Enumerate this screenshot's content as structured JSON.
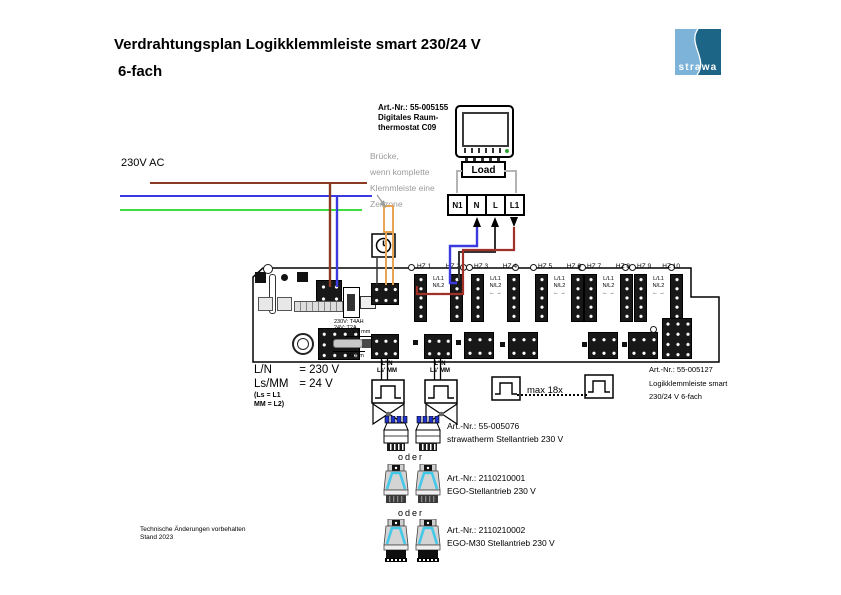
{
  "title": {
    "line1": "Verdrahtungsplan Logikklemmleiste smart 230/24 V",
    "line2": "6-fach"
  },
  "logo": {
    "text": "strawa"
  },
  "supply": {
    "label": "230V AC"
  },
  "thermostat": {
    "art": "Art.-Nr.: 55-005155",
    "name_line1": "Digitales Raum-",
    "name_line2": "thermostat C09",
    "load": "Load",
    "terminals": [
      "N1",
      "N",
      "L",
      "L1"
    ]
  },
  "bridge_note": {
    "line1": "Brücke,",
    "line2": "wenn komplette",
    "line3": "Klemmleiste eine",
    "line4": "Zeitzone"
  },
  "board": {
    "zones": [
      "HZ 1",
      "HZ 2",
      "HZ 3",
      "HZ 4",
      "HZ 5",
      "HZ 6",
      "HZ 7",
      "HZ 8",
      "HZ 9",
      "HZ 10"
    ],
    "row_top": "L/L1",
    "row_bottom": "N/L2",
    "row_arrows": "← →",
    "fuse_line1": "230V: T4AH",
    "fuse_line2": "24V: T2A",
    "dim_top": "1,3 mm",
    "dim_bottom": "90 mm",
    "art_line1": "Art.-Nr.: 55-005127",
    "art_line2": "Logikklemmleiste smart",
    "art_line3": "230/24 V 6-fach"
  },
  "legend": {
    "row1_key": "L/N",
    "row1_val": "= 230 V",
    "row2_key": "Ls/MM",
    "row2_val": "= 24 V",
    "note1": "(Ls = L1",
    "note2": "MM = L2)"
  },
  "outputs": {
    "top": "L' N",
    "bottom": "Ls' MM",
    "max": "max 18x"
  },
  "oder": "oder",
  "actuators": [
    {
      "art": "Art.-Nr.: 55-005076",
      "name": "strawatherm Stellantrieb 230 V"
    },
    {
      "art": "Art.-Nr.: 2110210001",
      "name": "EGO-Stellantrieb 230 V"
    },
    {
      "art": "Art.-Nr.: 2110210002",
      "name": "EGO-M30 Stellantrieb 230 V"
    }
  ],
  "footer": {
    "line1": "Technische Änderungen vorbehalten",
    "line2": "Stand 2023"
  },
  "colors": {
    "wire_brown": "#8a3a20",
    "wire_blue": "#3a3ae0",
    "wire_green": "#3fde3f",
    "wire_red": "#a03028",
    "wire_orange": "#e8a455",
    "wire_gray": "#b4b4b4",
    "note_gray": "#9b9b9b",
    "logo_light": "#7db3d9",
    "logo_dark": "#1d6587",
    "led_green": "#2fa32f"
  }
}
